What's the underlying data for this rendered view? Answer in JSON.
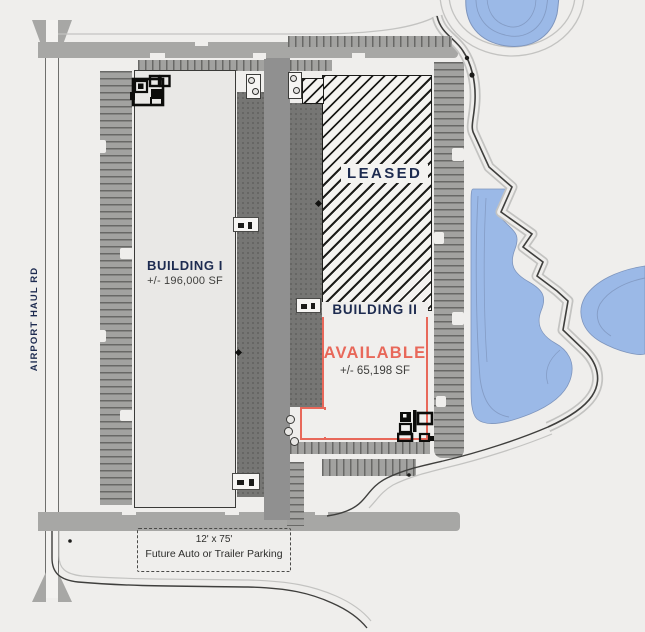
{
  "colors": {
    "bg": "#efeeec",
    "road": "#a7a7a5",
    "road_edge": "#6f6f6d",
    "parking": "#a2a2a0",
    "tick": "#686866",
    "apron": "#767674",
    "apron_dot": "#626260",
    "aisle": "#909090",
    "building_fill": "#e9e8e6",
    "building_border": "#3a3a38",
    "hatch_bg": "#f4f3f1",
    "hatch_line": "#1c1c1a",
    "navy": "#1d2b50",
    "coral": "#e8685a",
    "subtext": "#3e3e3c",
    "pond": "#9bb9e7",
    "pond_contour": "#7e95bd",
    "berm": "#c3c3c1",
    "boundary": "#3f3f3d",
    "dash": "#4a4a48",
    "structure": "#0c0c0a"
  },
  "roads": {
    "label": "AIRPORT HAUL RD"
  },
  "buildings": {
    "building1": {
      "name": "BUILDING I",
      "size": "+/- 196,000 SF"
    },
    "leased": {
      "label": "LEASED"
    },
    "building2": {
      "name": "BUILDING II",
      "status": "AVAILABLE",
      "size": "+/- 65,198 SF"
    }
  },
  "future_parking": {
    "dimensions": "12' x 75'",
    "label": "Future Auto or Trailer Parking"
  },
  "icons": {
    "office_footprint": "floor-plan-cluster",
    "guard_post": "box-with-bollards",
    "tree": "outlined-circle",
    "pond": "blue-water-blob"
  }
}
